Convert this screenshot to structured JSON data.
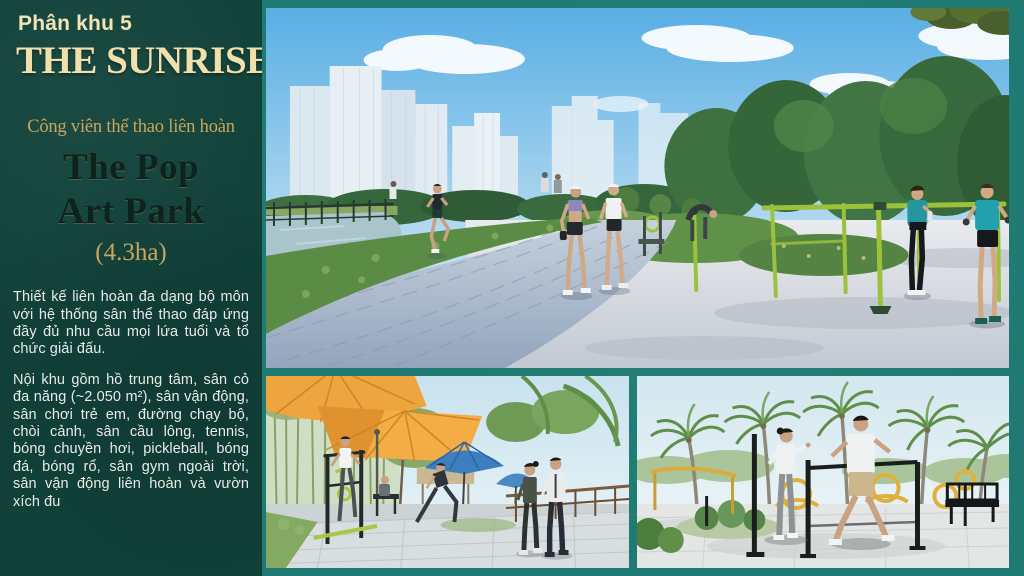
{
  "theme": {
    "sidebar_bg": "#11423a",
    "frame_teal": "#1e7a72",
    "gold": "#c9a55e",
    "cream": "#f0e0ac",
    "park_title_dark": "#0e231d",
    "body_text": "#e8ebe6",
    "equipment_lime": "#9cc23c",
    "equipment_yellow": "#e0b03e",
    "umbrella_orange": "#f0a83c",
    "umbrella_blue": "#3c7fc0"
  },
  "sidebar": {
    "badge": "Phân khu 5",
    "title": "THE SUNRISE",
    "park": {
      "subtitle": "Công viên thể thao liên hoàn",
      "name_line1": "The Pop",
      "name_line2": "Art Park",
      "area": "(4.3ha)"
    },
    "description": {
      "p1": "Thiết kế liên hoàn đa dạng bộ môn với hệ thống sân thể thao đáp ứng đầy đủ nhu cầu mọi lứa tuổi và tổ chức giải đấu.",
      "p2": "Nội khu gồm hồ trung tâm, sân cỏ đa năng (~2.050 m²), sân vận động, sân chơi trẻ em, đường chạy bộ, chòi cảnh, sân cầu lông, tennis, bóng chuyền hơi, pickleball, bóng đá, bóng rổ, sân gym ngoài trời, sân vận động liên hoàn và vườn xích đu"
    }
  }
}
